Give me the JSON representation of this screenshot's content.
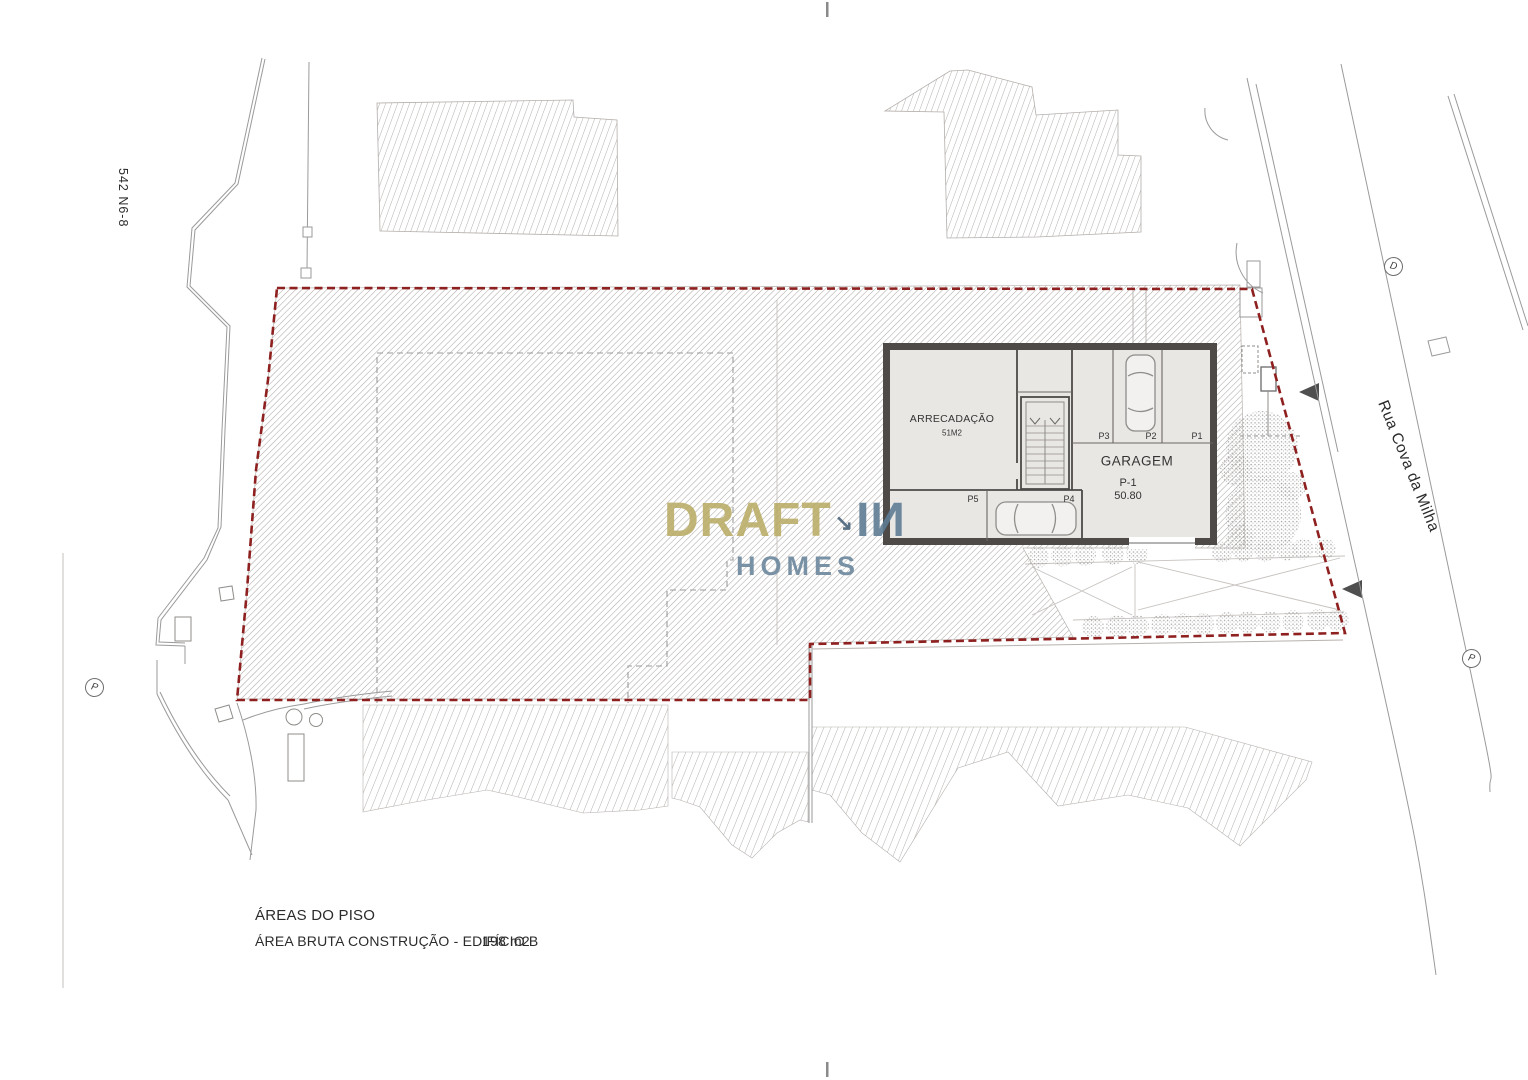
{
  "site": {
    "parcel_ref": "542 N6-8",
    "street_name": "Rua Cova da Milha"
  },
  "markers": {
    "d_circle": "D",
    "p_circle_left": "P",
    "p_circle_right": "P"
  },
  "building": {
    "storage_label": "ARRECADAÇÃO",
    "storage_area": "51M2",
    "garage_label": "GARAGEM",
    "garage_level": "P-1",
    "garage_area": "50.80",
    "stall_p1": "P1",
    "stall_p2": "P2",
    "stall_p3": "P3",
    "stall_p4": "P4",
    "stall_p5": "P5"
  },
  "watermark": {
    "part1": "DRAFT",
    "arrow_glyph": "↘",
    "part2": "IИ",
    "part3": "HOMES"
  },
  "footer": {
    "title": "ÁREAS DO PISO",
    "row_label": "ÁREA BRUTA CONSTRUÇÃO - EDIFÍCIO B",
    "row_value": "198 m2"
  },
  "colors": {
    "boundary_red": "#8e2020",
    "hatch_gray": "#aba6a3",
    "wall_dark": "#4d4a48",
    "watermark_olive": "#b6a960",
    "watermark_blue": "#5e7c94"
  }
}
